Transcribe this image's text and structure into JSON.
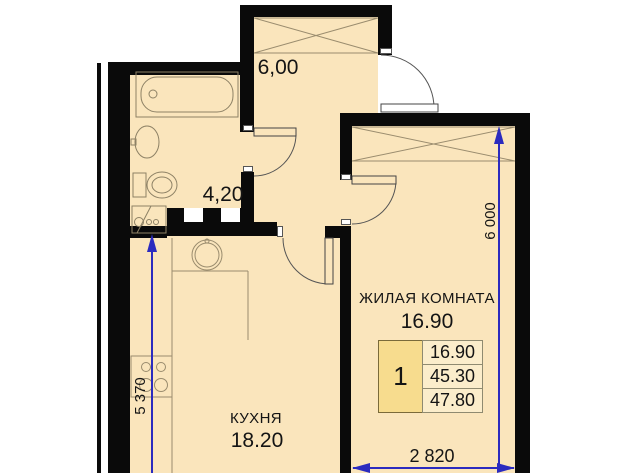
{
  "plan": {
    "type": "apartment-floor-plan",
    "rooms": {
      "hallway": {
        "area": "6,00"
      },
      "bathroom": {
        "area": "4,20"
      },
      "kitchen": {
        "name": "КУХНЯ",
        "area": "18.20"
      },
      "living": {
        "name": "ЖИЛАЯ КОМНАТА",
        "area": "16.90"
      }
    },
    "summary_table": {
      "rooms_count": "1",
      "living_area": "16.90",
      "area_without_balcony": "45.30",
      "total_area": "47.80"
    },
    "dimensions": {
      "living_width_mm": "2 820",
      "living_height_mm": "6 000",
      "kitchen_height_mm": "5 370"
    },
    "fixtures": [
      "bathtub",
      "washbasin",
      "toilet",
      "washing-machine",
      "kitchen-sink",
      "stove",
      "wardrobe",
      "doors"
    ],
    "colors": {
      "floor_fill": "#FAE5BC",
      "wall": "#0a0a0a",
      "dimension_blue": "#2b2bbf",
      "table_key_cell": "#F7DC8E",
      "fixture_line": "#8d8165"
    }
  }
}
